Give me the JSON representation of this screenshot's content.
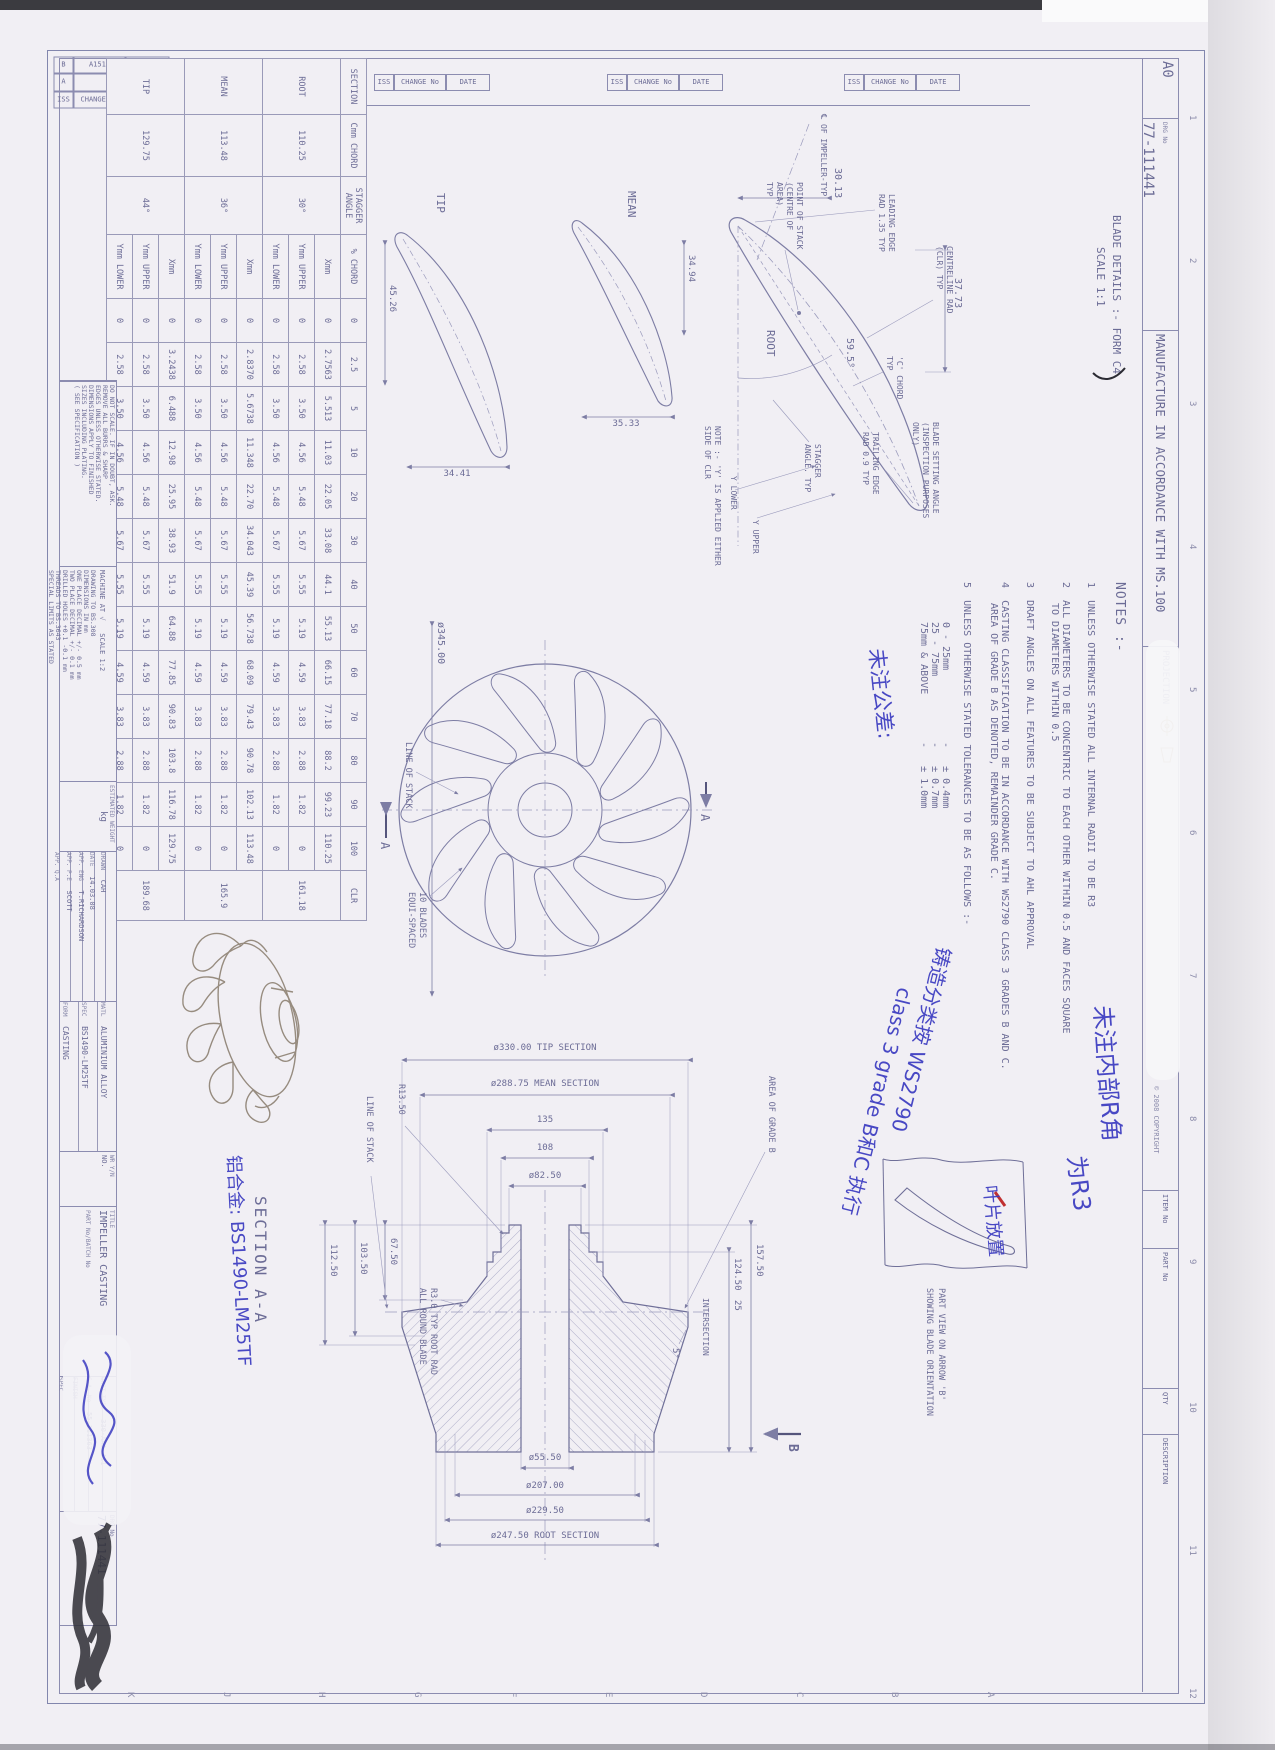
{
  "header": {
    "sheet": "A0",
    "drg_label": "DRG No",
    "drg_no": "77-111441",
    "manufacture": "MANUFACTURE IN ACCORDANCE WITH MS.100",
    "projection": "PROJECTION",
    "copyright": "© 2008 COPYRIGHT",
    "item_no": "ITEM No",
    "part_no": "PART No",
    "qty": "QTY",
    "description": "DESCRIPTION"
  },
  "ruler": {
    "numbers": [
      "1",
      "2",
      "3",
      "4",
      "5",
      "6",
      "7",
      "8",
      "9",
      "10",
      "11",
      "12"
    ],
    "letters": [
      "A",
      "B",
      "C",
      "D",
      "E",
      "F",
      "G",
      "H",
      "J",
      "K"
    ]
  },
  "revisions": {
    "header": [
      "ISS",
      "CHANGE No",
      "DATE"
    ],
    "rows": [
      [
        "B",
        "A1513",
        "11.09.08"
      ],
      [
        "A",
        "",
        "12.03.08"
      ]
    ]
  },
  "blade_details": {
    "title": "BLADE DETAILS :- FORM C4",
    "scale": "SCALE 1:1",
    "root": {
      "label": "ROOT",
      "d_top": "37.73",
      "d_left": "30.13",
      "angle": "59.5°",
      "l_cl": "℄ OF IMPELLER-TYP",
      "l_le1": "LEADING EDGE",
      "l_le2": "RAD 1.35 TYP",
      "l_pos1": "POINT OF STACK",
      "l_pos2": "(CENTRE OF",
      "l_pos3": "AREA)",
      "l_pos4": "TYP",
      "l_clr1": "CENTRELINE RAD",
      "l_clr2": "(CLR) TYP",
      "l_c1": "'C' CHORD",
      "l_c2": "TYP",
      "l_bsa1": "BLADE SETTING ANGLE",
      "l_bsa2": "(INSPECTION PURPOSES",
      "l_bsa3": "ONLY)",
      "l_te1": "TRAILING EDGE",
      "l_te2": "RAD 0.9 TYP",
      "l_sa1": "STAGGER",
      "l_sa2": "ANGLE. TYP",
      "l_yu": "Y UPPER",
      "l_yl": "Y LOWER",
      "l_note1": "NOTE :- 'Y' IS APPLIED EITHER",
      "l_note2": "SIDE OF CLR"
    },
    "mean": {
      "label": "MEAN",
      "d_top": "34.94",
      "d_right": "35.33"
    },
    "tip": {
      "label": "TIP",
      "d_bottom": "45.26",
      "d_right": "34.41"
    }
  },
  "front": {
    "dia": "ø345.00",
    "line_of_stack": "LINE OF STACK",
    "blades1": "10 BLADES",
    "blades2": "EQUI-SPACED",
    "a": "A"
  },
  "section": {
    "title": "SECTION  A-A",
    "tip": "ø330.00 TIP SECTION",
    "mean": "ø288.75 MEAN SECTION",
    "d135": "135",
    "d108": "108",
    "d82": "ø82.50",
    "bore": "ø55.50",
    "d207": "ø207.00",
    "d229": "ø229.50",
    "root": "ø247.50 ROOT SECTION",
    "h157": "157.50",
    "h124": "124.50",
    "h25": "25",
    "angle5": "5°",
    "intersection": "INTERSECTION",
    "area_b": "AREA OF GRADE B",
    "r13": "R13.50",
    "line_of_stack": "LINE OF STACK",
    "rootrad1": "R3.0 TYP ROOT RAD",
    "rootrad2": "ALL ROUND BLADE",
    "d67": "67.50",
    "d103": "103.50",
    "d112": "112.50",
    "b": "B"
  },
  "part_view": {
    "cap1": "PART VIEW ON ARROW 'B'",
    "cap2": "SHOWING BLADE ORIENTATION"
  },
  "notes": {
    "title": "NOTES :-",
    "n1": "1",
    "t1": "UNLESS OTHERWISE STATED ALL INTERNAL RADII TO BE R3",
    "n2": "2",
    "t2a": "ALL DIAMETERS TO BE CONCENTRIC TO EACH OTHER WITHIN 0.5 AND FACES SQUARE",
    "t2b": "TO DIAMETERS WITHIN 0.5",
    "n3": "3",
    "t3": "DRAFT ANGLES ON ALL FEATURES TO BE SUBJECT TO AHL APPROVAL",
    "n4": "4",
    "t4a": "CASTING CLASSIFICATION TO BE IN ACCORDANCE WITH WS2790 CLASS 3 GRADES B AND C.",
    "t4b": "AREA OF GRADE B AS DENOTED, REMAINDER GRADE C.",
    "n5": "5",
    "t5": "UNLESS OTHERWISE STATED TOLERANCES TO BE AS FOLLOWS :-",
    "tol": [
      [
        "0 - 25mm",
        "± 0.4mm"
      ],
      [
        "25 - 75mm",
        "± 0.7mm"
      ],
      [
        "75mm & ABOVE",
        "± 1.0mm"
      ]
    ]
  },
  "table": {
    "headers": {
      "section": "SECTION",
      "chord": "Cmm CHORD",
      "stagger": "STAGGER ANGLE",
      "pct": "% CHORD",
      "clr": "CLR"
    },
    "pct_cols": [
      "0",
      "2.5",
      "5",
      "10",
      "20",
      "30",
      "40",
      "50",
      "60",
      "70",
      "80",
      "90",
      "100"
    ],
    "row_labels": [
      "Xmm",
      "Ymm UPPER",
      "Ymm LOWER"
    ],
    "sections": [
      {
        "name": "ROOT",
        "chord": "110.25",
        "stagger": "30°",
        "clr": "161.18",
        "x": [
          "0",
          "2.7563",
          "5.513",
          "11.03",
          "22.05",
          "33.08",
          "44.1",
          "55.13",
          "66.15",
          "77.18",
          "88.2",
          "99.23",
          "110.25"
        ],
        "yu": [
          "0",
          "2.58",
          "3.50",
          "4.56",
          "5.48",
          "5.67",
          "5.55",
          "5.19",
          "4.59",
          "3.83",
          "2.88",
          "1.82",
          "0"
        ],
        "yl": [
          "0",
          "2.58",
          "3.50",
          "4.56",
          "5.48",
          "5.67",
          "5.55",
          "5.19",
          "4.59",
          "3.83",
          "2.88",
          "1.82",
          "0"
        ]
      },
      {
        "name": "MEAN",
        "chord": "113.48",
        "stagger": "36°",
        "clr": "165.9",
        "x": [
          "0",
          "2.8370",
          "5.6738",
          "11.348",
          "22.70",
          "34.043",
          "45.39",
          "56.738",
          "68.09",
          "79.43",
          "90.78",
          "102.13",
          "113.48"
        ],
        "yu": [
          "0",
          "2.58",
          "3.50",
          "4.56",
          "5.48",
          "5.67",
          "5.55",
          "5.19",
          "4.59",
          "3.83",
          "2.88",
          "1.82",
          "0"
        ],
        "yl": [
          "0",
          "2.58",
          "3.50",
          "4.56",
          "5.48",
          "5.67",
          "5.55",
          "5.19",
          "4.59",
          "3.83",
          "2.88",
          "1.82",
          "0"
        ]
      },
      {
        "name": "TIP",
        "chord": "129.75",
        "stagger": "44°",
        "clr": "189.68",
        "x": [
          "0",
          "3.2438",
          "6.488",
          "12.98",
          "25.95",
          "38.93",
          "51.9",
          "64.88",
          "77.85",
          "90.83",
          "103.8",
          "116.78",
          "129.75"
        ],
        "yu": [
          "0",
          "2.58",
          "3.50",
          "4.56",
          "5.48",
          "5.67",
          "5.55",
          "5.19",
          "4.59",
          "3.83",
          "2.88",
          "1.82",
          "0"
        ],
        "yl": [
          "0",
          "2.58",
          "3.50",
          "4.56",
          "5.48",
          "5.67",
          "5.55",
          "5.19",
          "4.59",
          "3.83",
          "2.88",
          "1.82",
          "0"
        ]
      }
    ]
  },
  "title_block": {
    "do_not_scale": [
      "DO NOT SCALE. IF IN DOUBT, ASK.",
      "REMOVE ALL BURRS & SHARP",
      "EDGES UNLESS OTHERWISE STATED.",
      "DIMENSIONS APPLY TO FINISHED",
      "SIZES INCLUDING PLATING.",
      "( SEE SPECIFICATION )"
    ],
    "machine_at": "MACHINE AT",
    "machine_sym": "√",
    "scale": "SCALE  1:2",
    "standards": [
      "DRAWING TO BS.308",
      "DIMENSIONS IN mm",
      "ONE PLACE DECIMAL +/- 0.5 mm",
      "TWO PLACE DECIMAL +/- 0.1 mm",
      "DRILLED HOLES +0.1 -0.1 mm",
      "THREADS TO BS.3643",
      "SPECIAL LIMITS AS STATED"
    ],
    "est_weight_label": "ESTIMATED WEIGHT",
    "est_weight": "kg",
    "drawn_label": "DRAWN",
    "drawn": "CAH",
    "date_label": "DATE",
    "date": "14.03.08",
    "app_eng_label": "APP. ENG",
    "app_eng": "T.RICHARDSON",
    "app_pe_label": "APP. P.E",
    "app_pe": "SCOTT",
    "app_qa_label": "APP. Q.A",
    "app_qa": "",
    "matl_label": "MATL",
    "matl": "ALUMINIUM ALLOY",
    "spec_label": "SPEC",
    "spec": "BS1490-LM25TF",
    "form_label": "FORM",
    "form": "CASTING",
    "wr_label": "WR Y/N",
    "wr": "NO.",
    "title_label": "TITLE",
    "title": "IMPELLER CASTING",
    "part_batch_label": "PART No/BATCH No",
    "unit_label": "UNIT TYPE",
    "unit": "330-AA1-411",
    "ga_label": "G.A. No",
    "ga": "55-111363",
    "finish_label": "FINISH",
    "spec2_label": "SPEC",
    "drg_label": "DRG No",
    "drg_no": "77-111441"
  },
  "annotations": {
    "radii1": "未注内部R角",
    "radii2": "为R3",
    "tol": "未注公差:",
    "casting1": "铸造分类按 WS2790",
    "casting2": "class 3 grade B和C 执行",
    "blade": "叶片放置",
    "alloy": "铝合金: BS1490-LM25TF"
  }
}
